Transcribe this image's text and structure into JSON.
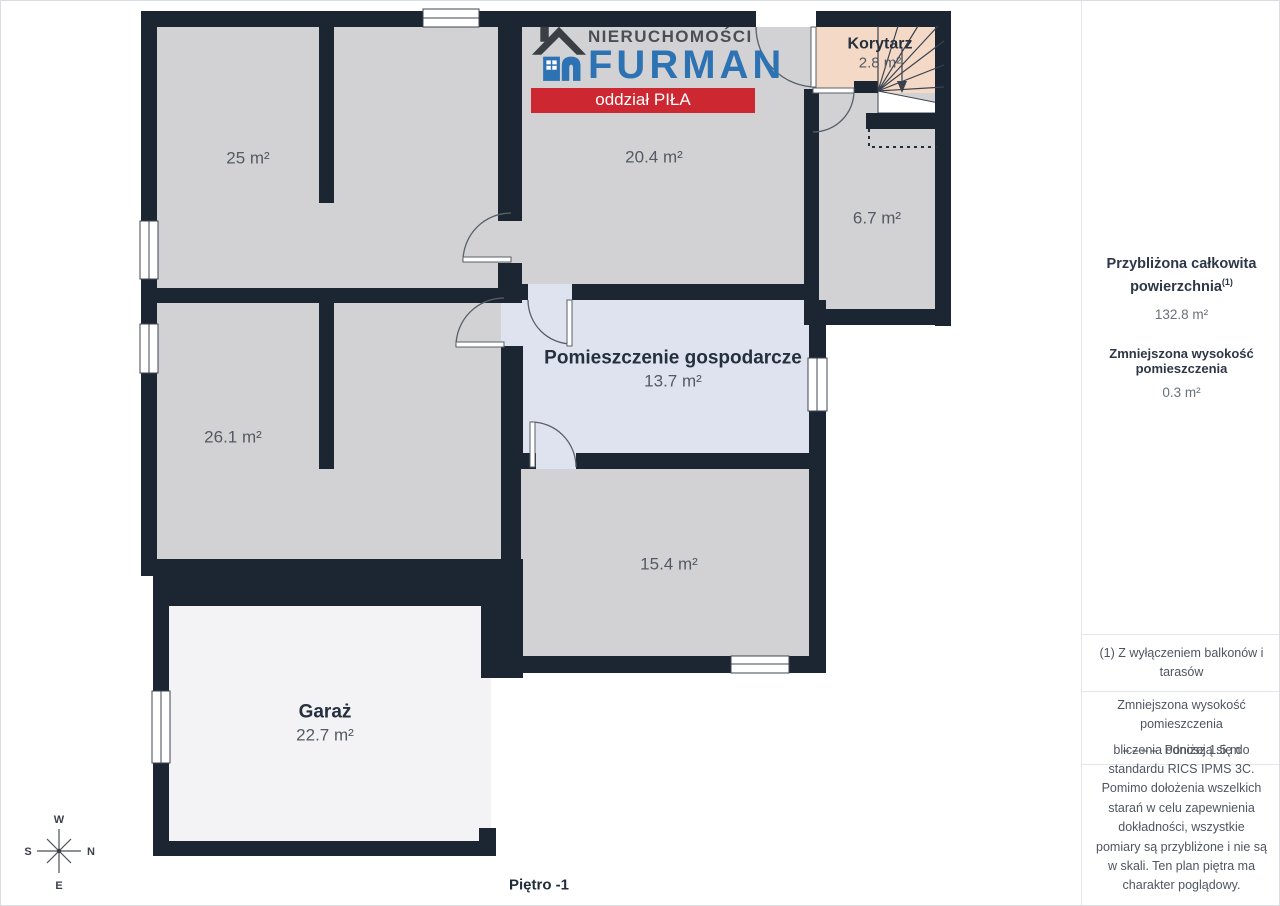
{
  "logo": {
    "name_top": "NIERUCHOMOŚCI",
    "name_main": "FURMAN",
    "branch": "oddział PIŁA"
  },
  "rooms": {
    "r25": {
      "area": "25 m²"
    },
    "r204": {
      "area": "20.4 m²"
    },
    "korytarz": {
      "name": "Korytarz",
      "area": "2.8 m²"
    },
    "r67": {
      "area": "6.7 m²"
    },
    "r261": {
      "area": "26.1 m²"
    },
    "gospodarcze": {
      "name": "Pomieszczenie gospodarcze",
      "area": "13.7 m²"
    },
    "r154": {
      "area": "15.4 m²"
    },
    "garaz": {
      "name": "Garaż",
      "area": "22.7 m²"
    }
  },
  "floor_label": "Piętro -1",
  "compass": {
    "top": "W",
    "right": "N",
    "bottom": "E",
    "left": "S"
  },
  "sidebar": {
    "total_title": "Przybliżona całkowita powierzchnia",
    "total_sup": "(1)",
    "total_value": "132.8 m²",
    "reduced_title": "Zmniejszona wysokość pomieszczenia",
    "reduced_value": "0.3 m²",
    "footnote": "(1) Z wyłączeniem balkonów i tarasów",
    "legend_title": "Zmniejszona wysokość pomieszczenia",
    "legend_value": "Poniżej 1.5 m",
    "disclaimer": "bliczenia odnoszą się do standardu RICS IPMS 3C. Pomimo dołożenia wszelkich starań w celu zapewnienia dokładności, wszystkie pomiary są przybliżone i nie są w skali. Ten plan piętra ma charakter poglądowy.",
    "brand": "GIRAFFE",
    "brand_bold": "360"
  },
  "colors": {
    "wall": "#1c2532",
    "room_gray": "#d2d2d4",
    "room_blue": "#dfe3ef",
    "room_peach": "#f4d9c6",
    "garage": "#f3f3f5",
    "logo_blue": "#2d73b4",
    "banner_red": "#cd2731"
  }
}
